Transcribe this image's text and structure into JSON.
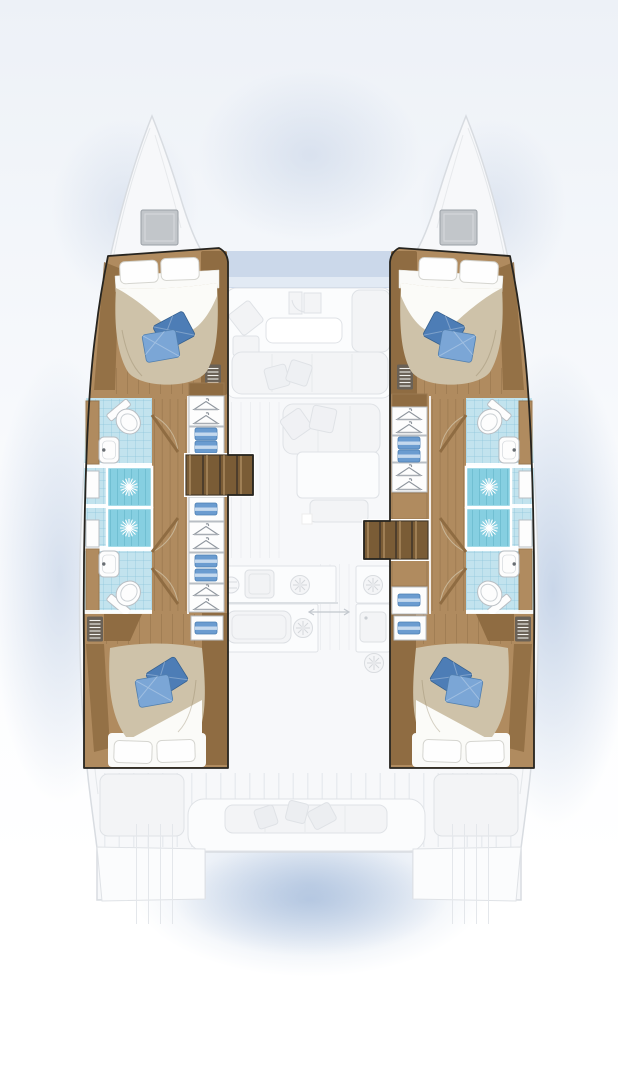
{
  "title": "Catamaran accommodation floor plan (top-down)",
  "visible_text": [],
  "diagram": {
    "type": "boat-floor-plan",
    "vessel": "sailing catamaran, twin hulls",
    "view": "overhead deck and cabin layout",
    "highlighted": "both hull interiors in full colour; central saloon, galley and cockpits faded grey",
    "features": {
      "double_cabins": 4,
      "double_beds": 4,
      "bathrooms": 4,
      "showers": 4,
      "toilets": 4,
      "washbasins": 4,
      "wardrobe_lockers": 14,
      "companionway_stairs": 2,
      "bow_deck_hatches": 2,
      "bed_accent_pillows_per_bed": 2
    }
  },
  "icons": [
    {
      "name": "shower-starburst-icon",
      "meaning": "shower drain"
    },
    {
      "name": "toilet-icon",
      "meaning": "marine toilet"
    },
    {
      "name": "sink-icon",
      "meaning": "washbasin with tap"
    },
    {
      "name": "hanger-icon",
      "meaning": "hanging wardrobe locker"
    },
    {
      "name": "folded-clothes-icon",
      "meaning": "shelved clothes locker"
    },
    {
      "name": "louver-vent-icon",
      "meaning": "ventilation grille"
    },
    {
      "name": "door-swing-icon",
      "meaning": "door with swing arc"
    },
    {
      "name": "burner-icon",
      "meaning": "galley stove burner"
    },
    {
      "name": "slide-arrow-icon",
      "meaning": "sliding door track"
    }
  ],
  "palette": {
    "pageTop": "#edf1f7",
    "white": "#ffffff",
    "outline": "#26241f",
    "hullFill": "#f7f8fa",
    "hullLine": "#d8dce1",
    "fadeFill": "#f3f4f6",
    "fadeLine": "#dfe2e6",
    "fadeDark": "#d8dbe0",
    "wood": "#b08b5f",
    "woodDark": "#8f6c42",
    "woodLine": "#9a7850",
    "stepWood": "#7a5c36",
    "duvet": "#cec2a9",
    "sheet": "#fbfbf8",
    "pillowBlue": "#4d7db6",
    "pillowBlueLight": "#7ba6d6",
    "bathFloor": "#c2e3ee",
    "bathTile": "#8ec4d8",
    "shower": "#86cfe1",
    "showerLine": "#5fb4cb",
    "fixture": "#fdfdfd",
    "fixtureLine": "#b9bec3",
    "hatch": "#c2c6ca",
    "hatchLine": "#9aa0a6",
    "vent": "#6a6156",
    "hanger": "#8e959d",
    "clothes": "#6b9cd0",
    "clothesLight": "#cfe0f1",
    "glass": "#cbd8ea",
    "glassLight": "#e6edf6"
  }
}
